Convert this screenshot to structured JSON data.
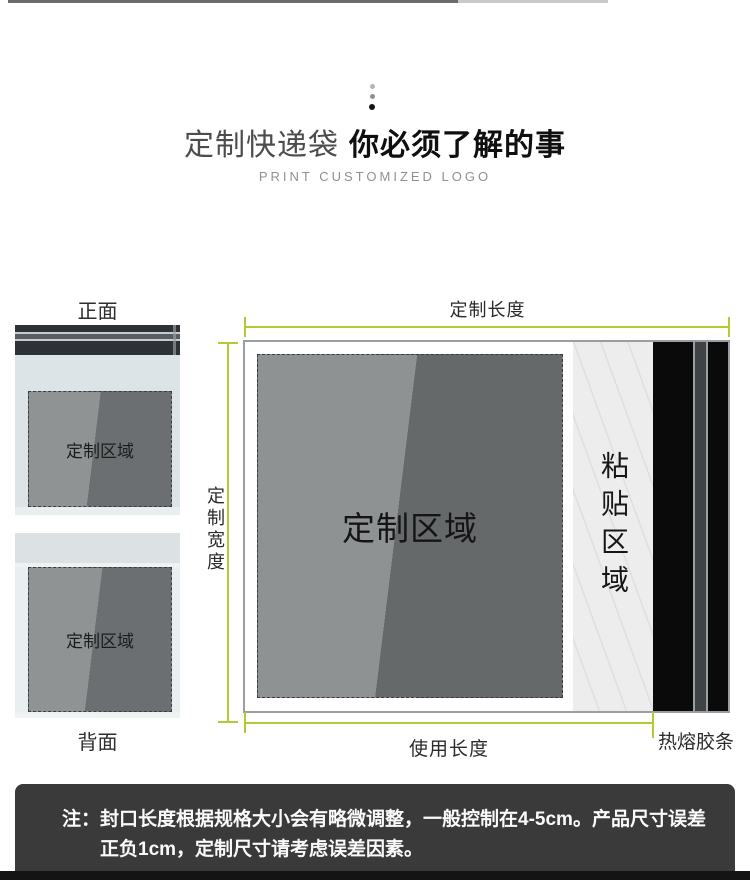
{
  "header": {
    "title_regular": "定制快递袋",
    "title_bold": "你必须了解的事",
    "subtitle": "PRINT CUSTOMIZED LOGO"
  },
  "side_views": {
    "front_label": "正面",
    "front_area_label": "定制区域",
    "back_label": "背面",
    "back_area_label": "定制区域"
  },
  "main_diagram": {
    "top_dimension_label": "定制长度",
    "left_dimension_label": "定制宽度",
    "bottom_dimension_label": "使用长度",
    "custom_area_label": "定制区域",
    "glue_area_label": "粘贴区域",
    "hot_melt_strip_label": "热熔胶条"
  },
  "note": {
    "prefix": "注：",
    "line1": "封口长度根据规格大小会有略微调整，一般控制在4-5cm。产品尺寸误差",
    "line2": "正负1cm，定制尺寸请考虑误差因素。"
  },
  "colors": {
    "dimension_line": "#b2cb32",
    "note_background": "#3a3a3a",
    "band_black": "#0a0a0a",
    "area_gray_light": "#8f9394",
    "area_gray_dark": "#656969"
  }
}
